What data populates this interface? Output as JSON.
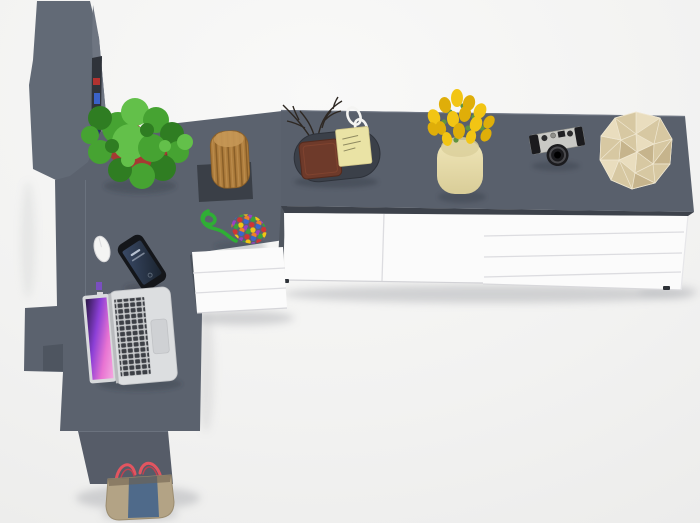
{
  "scene": {
    "type": "3d-furniture-render-top-view",
    "objects": [
      "tall-bookshelf-cabinet",
      "desk-return",
      "sideboard-countertop",
      "sideboard-doors",
      "sideboard-drawers",
      "pedestal-drawers",
      "potted-fern-plant",
      "wooden-log-stool",
      "bead-rope-toy",
      "smartphone",
      "computer-mouse",
      "open-laptop",
      "desk-tray",
      "leather-wallet",
      "sticky-notes",
      "decorative-twigs",
      "white-glasses",
      "yellow-tulips-in-vase",
      "vintage-camera",
      "faceted-deco-polyhedron",
      "tote-bag"
    ]
  },
  "colors": {
    "floor": "#f2f2f1",
    "cabinet_top": "#626a76",
    "cabinet_side": "#6e7581",
    "shelf_interior": "#2f333a",
    "desk_surface": "#5b626e",
    "desk_side": "#49505a",
    "desk_front": "#565c68",
    "desk_step": "#4e5560",
    "counter_top": "#59606c",
    "counter_gap": "#3d424b",
    "side_sliver": "#50565f",
    "white_front": "#fbfbfb",
    "front_seam": "#dcdce0",
    "foot_dark": "#2e3238",
    "pot_red": "#a63a33",
    "pot_red_dark": "#8c2e29",
    "leaf_dark": "#2f7d22",
    "leaf_mid": "#46a332",
    "leaf_light": "#63c04a",
    "stool_wood": "#ad7c3c",
    "stool_wood_dark": "#8a5f28",
    "stool_wood_light": "#c59755",
    "stool_base": "#3a3f47",
    "rope_green": "#2fae35",
    "beads": [
      "#d03434",
      "#3a66cc",
      "#f2c514",
      "#9b3fc4",
      "#3aa23a",
      "#f07f28"
    ],
    "books": [
      "#b23230",
      "#3a62c8",
      "#d8d8da",
      "#28306e",
      "#8a2f28",
      "#caa23a",
      "#7a4fc0"
    ],
    "phone_body": "#14161a",
    "screen_line": "#cfd8e6",
    "mouse_white": "#f4f4f3",
    "laptop_silver": "#dcdee0",
    "laptop_bezel": "#d8dadc",
    "laptop_keybed": "#c6c8ca",
    "laptop_keys": "#3c3f45",
    "laptop_trackpad": "#cfd1d4",
    "tray": "#3b4049",
    "wallet": "#6e3a2a",
    "sticky_note": "#eae3a5",
    "twigs": "#2e2823",
    "glasses_white": "#f4f4f2",
    "vase": "#ece2b0",
    "tulip_a": "#f2c514",
    "tulip_b": "#dfae09",
    "stem_green": "#5f9340",
    "camera_silver": "#c9c9c5",
    "camera_black": "#1b1b1e",
    "poly_light": "#e9ddbe",
    "poly_mid": "#d7c8a2",
    "poly_dark": "#c6b48c",
    "bag_body": "#b3a385",
    "bag_denim": "#4f6a8a",
    "bag_handle": "#e25560",
    "shadow_floor": "#aeb0b4",
    "shadow_dark": "#2f3540"
  }
}
